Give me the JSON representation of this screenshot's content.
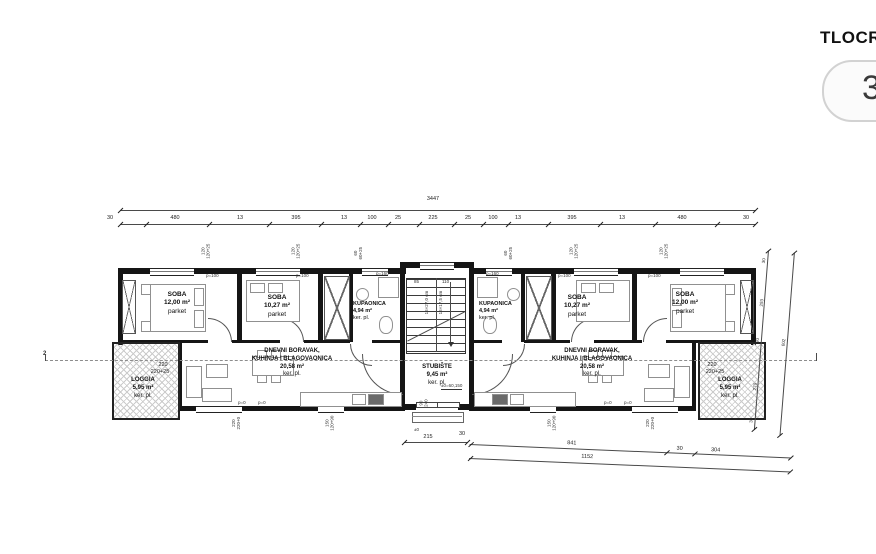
{
  "panel": {
    "title": "TLOCRT",
    "badge": "3"
  },
  "dims": {
    "total": "3447",
    "top": [
      "30",
      "480",
      "13",
      "395",
      "13",
      "100",
      "25",
      "225",
      "25",
      "100",
      "13",
      "395",
      "13",
      "480",
      "30"
    ],
    "bottom": [
      "215",
      "30",
      "841",
      "30",
      "304"
    ],
    "bottom_total": "1152",
    "right": [
      "30",
      "293",
      "30",
      "270",
      "30"
    ],
    "right_total": "602",
    "stair_w1": "85",
    "stair_w2": "110",
    "loggia_l1": "220",
    "loggia_l2": "220+25",
    "section": "2",
    "pm0": "±0"
  },
  "windows": {
    "large_a": "120",
    "large_b": "120+25",
    "small_a": "60",
    "small_b": "60+25",
    "door_a": "220",
    "door_b": "220+0",
    "kitchen_a": "150",
    "kitchen_b": "120+90",
    "entry_a": "90",
    "entry_b": "240",
    "p100": "p=100",
    "p160": "p=160",
    "p0": "p=0"
  },
  "rooms": {
    "l_soba1": {
      "name": "SOBA",
      "area": "12,00 m²",
      "floor": "parket"
    },
    "l_soba2": {
      "name": "SOBA",
      "area": "10,27 m²",
      "floor": "parket"
    },
    "l_bath": {
      "name": "KUPAONICA",
      "area": "4,94 m²",
      "floor": "ker. pl."
    },
    "l_living": {
      "l1": "DNEVNI BORAVAK,",
      "l2": "KUHINJA I BLAGOVAONICA",
      "area": "20,58 m²",
      "floor": "ker. pl."
    },
    "l_loggia": {
      "name": "LOGGIA",
      "area": "5,95 m²",
      "floor": "ker. pl."
    },
    "r_soba1": {
      "name": "SOBA",
      "area": "10,27 m²",
      "floor": "parket"
    },
    "r_soba2": {
      "name": "SOBA",
      "area": "12,00 m²",
      "floor": "parket"
    },
    "r_bath": {
      "name": "KUPAONICA",
      "area": "4,94 m²",
      "floor": "ker. pl."
    },
    "r_living": {
      "l1": "DNEVNI BORAVAK,",
      "l2": "KUHINJA I BLAGOVAONICA",
      "area": "20,58 m²",
      "floor": "ker. pl."
    },
    "r_loggia": {
      "name": "LOGGIA",
      "area": "5,95 m²",
      "floor": "ker. pl."
    },
    "stairs": {
      "name": "STUBIŠTE",
      "area": "9,45 m²",
      "floor": "ker. pl.",
      "level": "±0=60,150",
      "run1": "16×27,0 cm",
      "run2": "16×17,5 cm"
    }
  }
}
